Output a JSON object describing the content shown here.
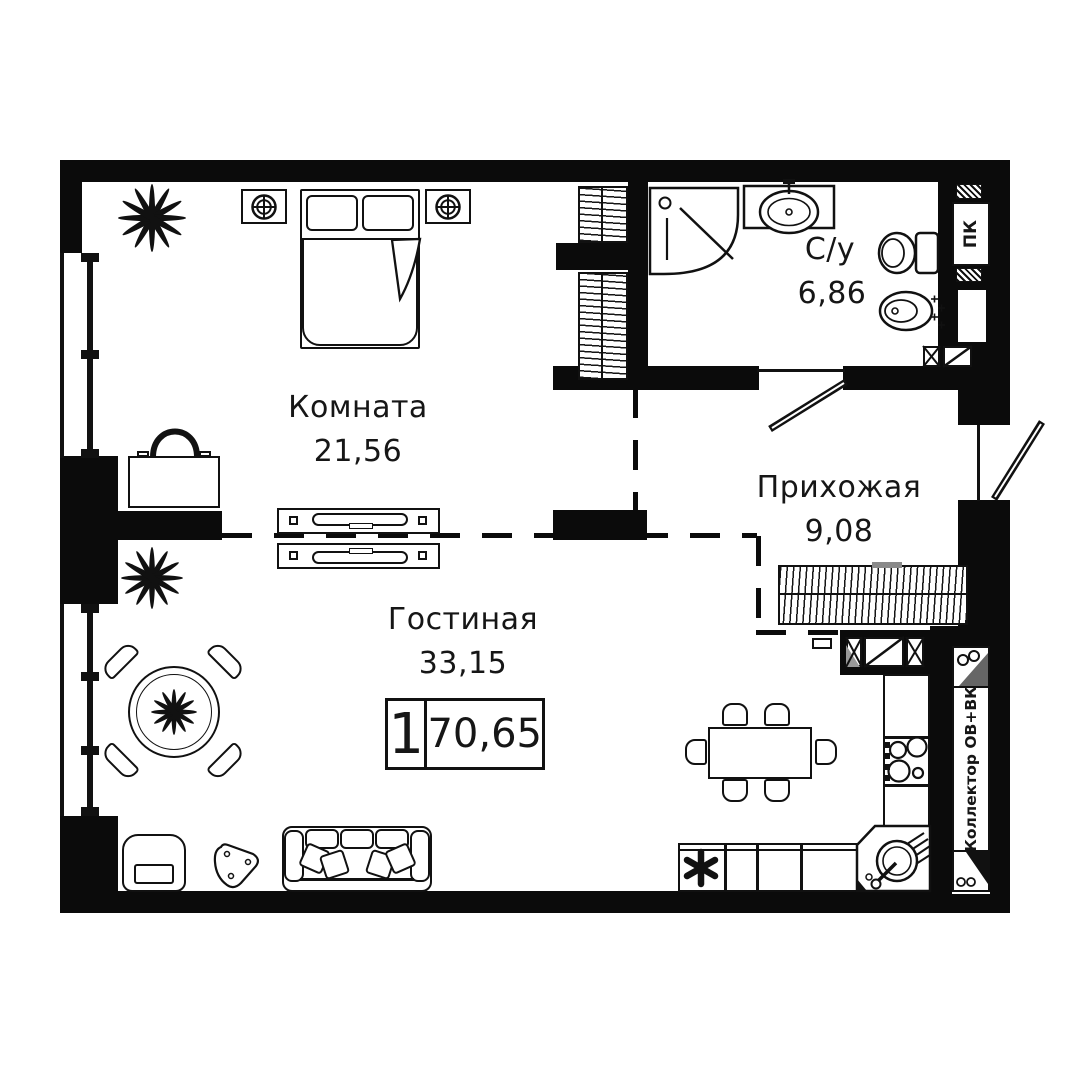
{
  "floorplan": {
    "badge": {
      "rooms_count": "1",
      "total_area": "70,65"
    },
    "rooms": [
      {
        "name": "Комната",
        "area": "21,56"
      },
      {
        "name": "Гостиная",
        "area": "33,15"
      },
      {
        "name": "Прихожая",
        "area": "9,08"
      },
      {
        "name": "С/у",
        "area": "6,86"
      }
    ],
    "labels": {
      "fire_cabinet": "ПК",
      "collector": "Коллектор ОВ+ВК"
    },
    "colors": {
      "walls": "#0b0b0b",
      "background": "#ffffff",
      "accent_gray": "#8a8a8a"
    }
  }
}
